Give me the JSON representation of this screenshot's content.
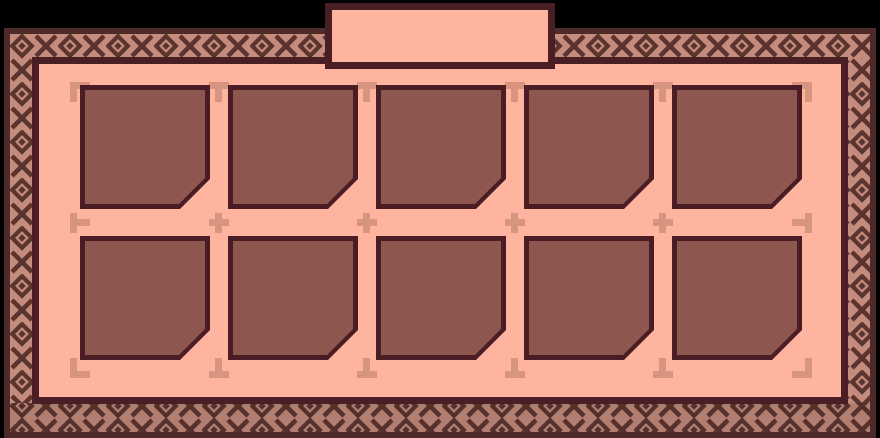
{
  "tab": {
    "label": ""
  },
  "inventory": {
    "rows": 2,
    "columns": 5,
    "slot_count": 10,
    "slots": [
      {
        "slot": 1,
        "item": ""
      },
      {
        "slot": 2,
        "item": ""
      },
      {
        "slot": 3,
        "item": ""
      },
      {
        "slot": 4,
        "item": ""
      },
      {
        "slot": 5,
        "item": ""
      },
      {
        "slot": 6,
        "item": ""
      },
      {
        "slot": 7,
        "item": ""
      },
      {
        "slot": 8,
        "item": ""
      },
      {
        "slot": 9,
        "item": ""
      },
      {
        "slot": 10,
        "item": ""
      }
    ]
  },
  "icons": {
    "trim_pattern": "diamond-and-x-trim-icon",
    "guide_corner": "corner-bracket-icon",
    "guide_edge": "t-mark-icon",
    "guide_cross": "plus-mark-icon"
  },
  "colors": {
    "backdrop": "#000000",
    "frame_line": "#4e2a28",
    "trim_background": "#c48c7c",
    "trim_background_bottom": "#b27e71",
    "trim_motif": "#5b332f",
    "trim_motif_bottom": "#55302c",
    "panel_fill": "#ffb4a0",
    "panel_border": "#491f25",
    "slot_fill": "#8d564e",
    "slot_border": "#4a1d24",
    "guide_marks": "#d7947f"
  }
}
